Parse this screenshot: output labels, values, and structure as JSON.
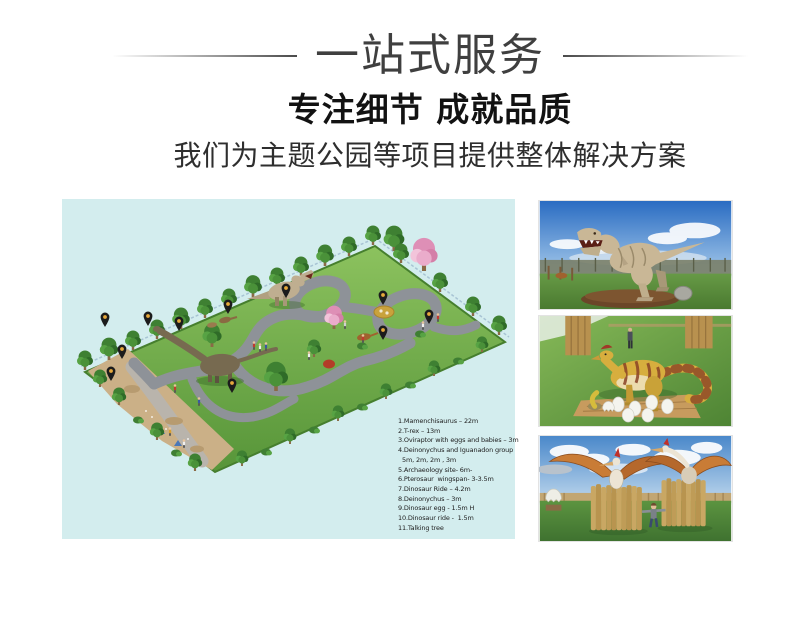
{
  "header": {
    "banner_title": "一站式服务",
    "heading": "专注细节 成就品质",
    "subheading": "我们为主题公园等项目提供整体解决方案"
  },
  "plan": {
    "pin_icon": "map-pin-icon",
    "pin_count": 11,
    "background_color": "#d3edee",
    "pin_color": "#1c1c1c",
    "pin_dot_color": "#e6a93c",
    "legend_lines": [
      "1.Mamenchisaurus – 22m",
      "2.T-rex – 13m",
      "3.Oviraptor with eggs and babies – 3m",
      "4.Deinonychus and Iguanadon group",
      "5m, 2m, 2m , 3m",
      "5.Archaeology site- 6m-",
      "6.Pterosaur  wingspan- 3-3.5m",
      "7.Dinosaur Ride – 4.2m",
      "8.Deinonychus – 3m",
      "9.Dinosaur egg - 1.5m H",
      "10.Dinosaur ride -  1.5m",
      "11.Talking tree"
    ]
  }
}
